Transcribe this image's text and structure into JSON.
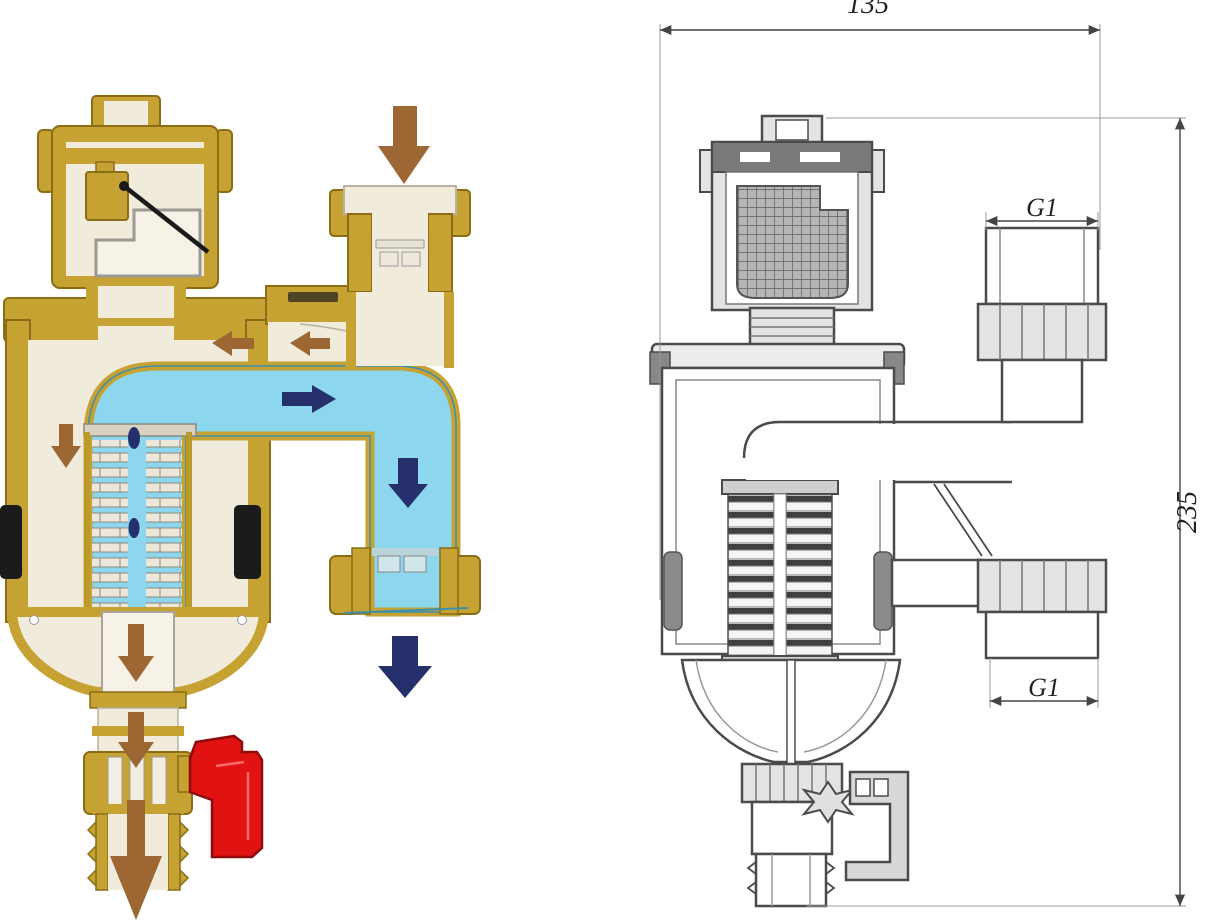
{
  "palette": {
    "brass": "#c6a233",
    "brass_edge": "#8a6d14",
    "brass_light": "#e8cf6a",
    "cream": "#f1ebdc",
    "cream_edge": "#b9b2a0",
    "water": "#8cd6ee",
    "water_edge": "#3e8fae",
    "navy": "#252f6b",
    "brown": "#9c6733",
    "red": "#e11212",
    "red_edge": "#8f0b0b",
    "magnet": "#1b1b1b",
    "line": "#4b4b4b",
    "line_soft": "#9a9a9a",
    "metal_fill": "#e4e4e4",
    "dim": "#444444"
  },
  "left_diagram": {
    "name": "Colored cutaway of magnetic dirt separator with automatic air vent, drain valve and flow arrows",
    "arrows": [
      {
        "id": "inlet-flow-arrow",
        "direction": "down",
        "color": "#9c6733"
      },
      {
        "id": "air-bubble-arrow-1",
        "direction": "left",
        "color": "#9c6733"
      },
      {
        "id": "air-bubble-arrow-2",
        "direction": "left",
        "color": "#9c6733"
      },
      {
        "id": "water-flow-arrow-right",
        "direction": "right",
        "color": "#252f6b"
      },
      {
        "id": "water-flow-arrow-down-channel",
        "direction": "down",
        "color": "#252f6b"
      },
      {
        "id": "outlet-flow-arrow",
        "direction": "down",
        "color": "#252f6b"
      },
      {
        "id": "dirt-settle-arrow-top",
        "direction": "down",
        "color": "#9c6733"
      },
      {
        "id": "dirt-funnel-arrow",
        "direction": "down",
        "color": "#9c6733"
      },
      {
        "id": "dirt-neck-arrow",
        "direction": "down",
        "color": "#9c6733"
      },
      {
        "id": "drain-outlet-arrow",
        "direction": "down",
        "color": "#9c6733"
      }
    ]
  },
  "right_diagram": {
    "name": "Dimensioned sectional technical drawing of the separator",
    "labels": {
      "overall_width": "135",
      "overall_height": "235",
      "top_port": "G1",
      "bottom_port": "G1"
    }
  }
}
